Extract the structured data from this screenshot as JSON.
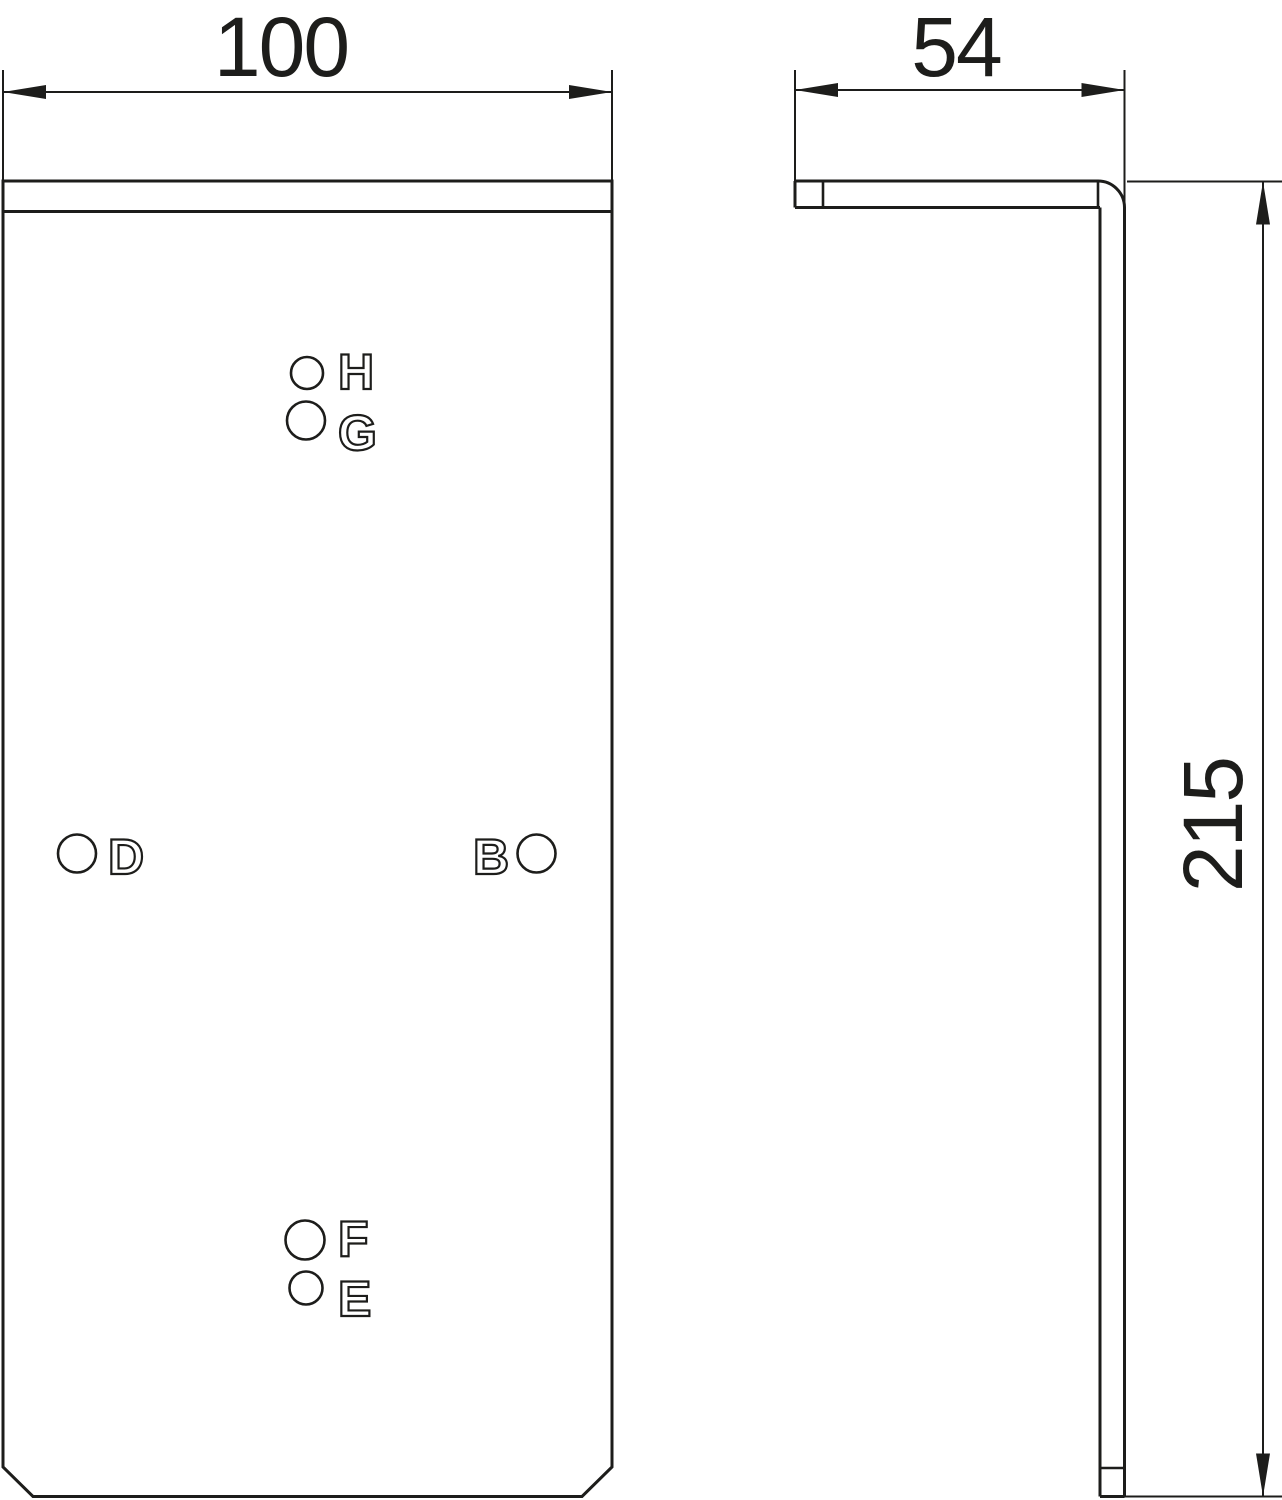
{
  "colors": {
    "line": "#1d1d1b",
    "background": "#ffffff"
  },
  "dimensions": {
    "width": {
      "value": "100"
    },
    "depth": {
      "value": "54"
    },
    "height": {
      "value": "215"
    }
  },
  "holes": [
    {
      "label": "H"
    },
    {
      "label": "G"
    },
    {
      "label": "D"
    },
    {
      "label": "B"
    },
    {
      "label": "F"
    },
    {
      "label": "E"
    }
  ]
}
